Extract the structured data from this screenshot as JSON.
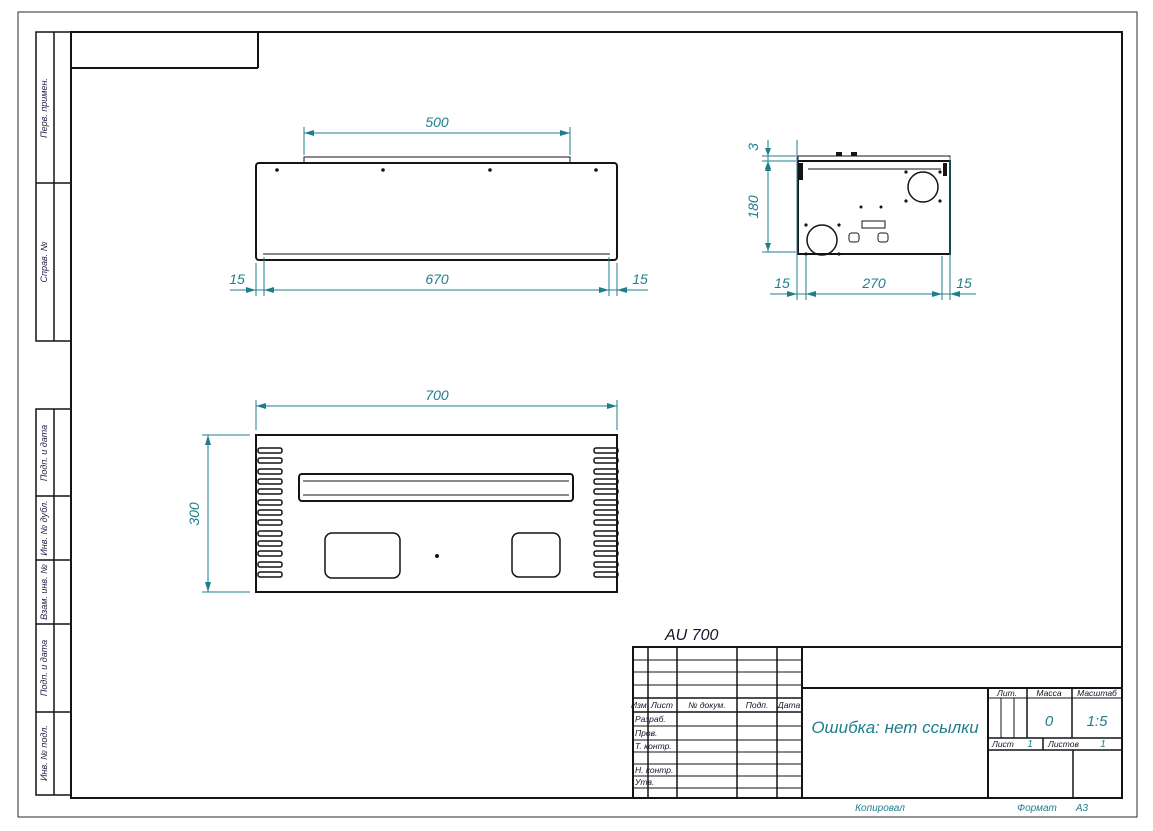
{
  "margin_labels": {
    "top": [
      "Перв. примен.",
      "Справ. №"
    ],
    "bottom": [
      "Подп. и дата",
      "Инв. № дубл.",
      "Взам. инв. №",
      "Подп. и дата",
      "Инв. № подл."
    ]
  },
  "views": {
    "label": "AU 700",
    "front": {
      "dim_flange": "500",
      "dim_inner": "670",
      "dim_left": "15",
      "dim_right": "15"
    },
    "side": {
      "dim_lid": "3",
      "dim_height": "180",
      "dim_inner": "270",
      "dim_left": "15",
      "dim_right": "15"
    },
    "bottom": {
      "dim_width": "700",
      "dim_height": "300"
    }
  },
  "title_block": {
    "cols": {
      "izm": "Изм.",
      "list": "Лист",
      "doc": "№ докум.",
      "podp": "Подп.",
      "date": "Дата"
    },
    "rows": {
      "razrab": "Разраб.",
      "prov": "Пров.",
      "tkontr": "Т. контр.",
      "nkontr": "Н. контр.",
      "utv": "Утв."
    },
    "doc_title": "Ошибка: нет ссылки",
    "lit_label": "Лит.",
    "mass_label": "Масса",
    "scale_label": "Масштаб",
    "mass_value": "0",
    "scale_value": "1:5",
    "sheet_label": "Лист",
    "sheet_value": "1",
    "sheets_label": "Листов",
    "sheets_value": "1"
  },
  "footer": {
    "copied": "Копировал",
    "format_label": "Формат",
    "format_value": "А3"
  },
  "colors": {
    "dimension": "#1e7e8c",
    "line": "#141414"
  }
}
